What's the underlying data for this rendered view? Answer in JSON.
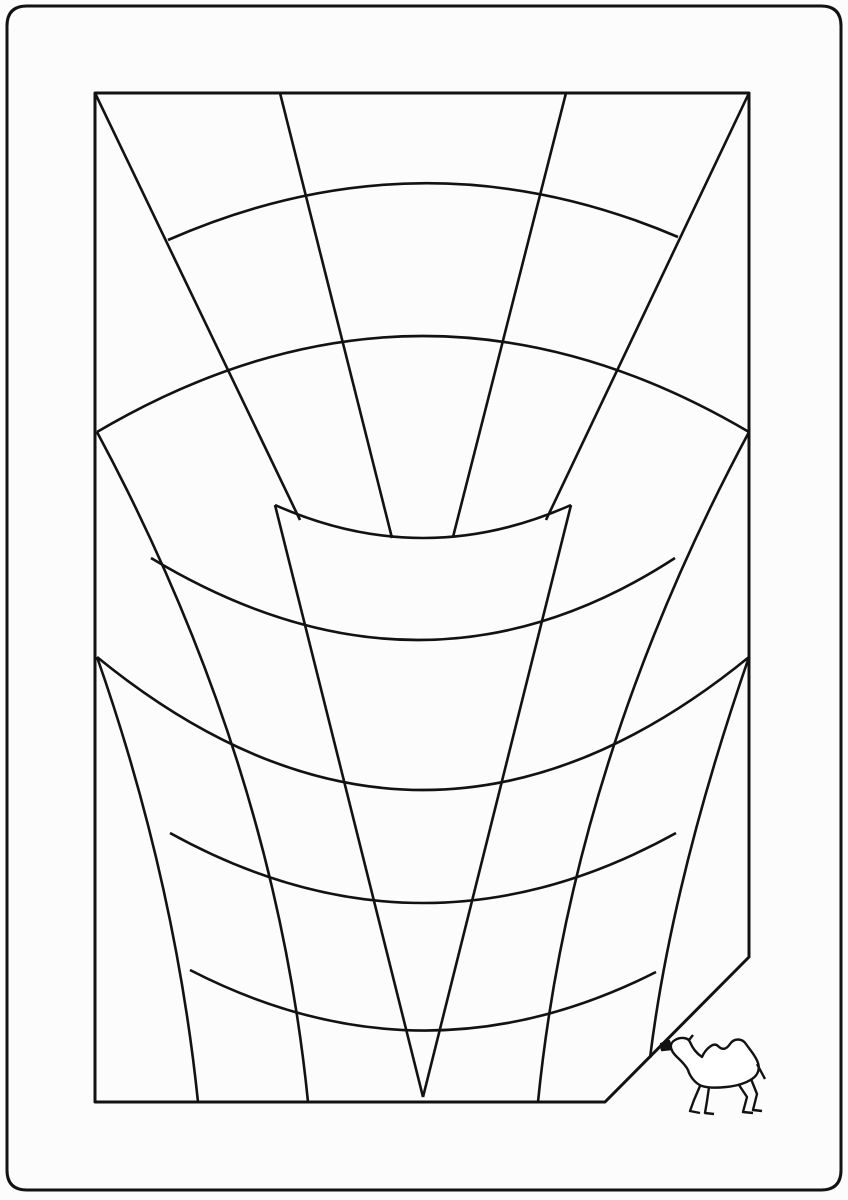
{
  "meta": {
    "description": "Maze puzzle line drawing with camel goal figure",
    "background_color": "#fcfcfc",
    "ink_color": "#121212",
    "line_width": 2.6,
    "frame_line_width": 3,
    "border_line_width": 3
  },
  "drawing": {
    "viewBox": "0 0 848 1200",
    "background": "#fcfcfc",
    "ink": "#121212",
    "frame": [
      {
        "name": "outer-rounded-border",
        "d": "M 27,6 H 821 Q 841,6 841,26 V 1170 Q 841,1190 821,1190 H 27 Q 7,1190 7,1170 V 26 Q 7,6 27,6 Z",
        "w": 3
      },
      {
        "name": "inner-frame-clipped-corner",
        "d": "M 95,93 H 749 V 957 L 605,1102 H 95 Z",
        "w": 3
      }
    ],
    "strokes": [
      {
        "name": "tier1-radial-left-corner",
        "d": "M 95,93 L 300,520"
      },
      {
        "name": "tier1-radial-center-left",
        "d": "M 280,93 L 392,538"
      },
      {
        "name": "tier1-radial-center-right",
        "d": "M 566,93 L 453,537"
      },
      {
        "name": "tier1-radial-right-corner",
        "d": "M 749,93 L 546,520"
      },
      {
        "name": "tier1-arc-upper",
        "d": "M 168,240 Q 423,128 678,237"
      },
      {
        "name": "tier1-arc-lower",
        "d": "M 97,432 Q 423,240 749,432"
      },
      {
        "name": "tier1-rim-sag",
        "d": "M 275,505 Q 423,571 571,505"
      },
      {
        "name": "tier2-radial-left-corner",
        "d": "M 97,432 Q 274,762 308,1102"
      },
      {
        "name": "tier2-radial-right-corner",
        "d": "M 749,432 Q 572,762 538,1102"
      },
      {
        "name": "tier2-radial-center-left",
        "d": "M 275,505 L 423,1097"
      },
      {
        "name": "tier2-radial-center-right",
        "d": "M 571,505 L 423,1097"
      },
      {
        "name": "tier2-arc-upper",
        "d": "M 151,558 Q 423,722 675,558"
      },
      {
        "name": "tier2-rim-sag",
        "d": "M 170,833 Q 423,973 676,833"
      },
      {
        "name": "tier3-radial-left-corner",
        "d": "M 97,657 Q 175,880 198,1102"
      },
      {
        "name": "tier3-radial-right-corner",
        "d": "M 749,657 Q 672,880 650,1058"
      },
      {
        "name": "tier3-arc-upper",
        "d": "M 97,657 Q 423,923 749,657"
      },
      {
        "name": "tier3-rim-sag",
        "d": "M 190,970 Q 423,1090 656,972"
      }
    ],
    "camel": {
      "name": "camel-figure",
      "body_fill": "#ffffff",
      "outline": "M 676,1056 C 671,1051 668,1044 675,1040 C 680,1037 688,1037 690,1042 C 692,1047 696,1053 702,1057 C 706,1048 714,1042 718,1046 C 722,1050 726,1050 730,1044 C 734,1038 742,1038 746,1044 C 750,1050 756,1056 758,1063 C 760,1069 758,1075 752,1079 C 746,1083 736,1086 726,1087 C 716,1088 708,1088 702,1086 C 696,1084 690,1077 688,1070 C 685,1064 680,1060 676,1056 Z",
      "details": [
        {
          "name": "camel-snout",
          "d": "M 669,1041 L 661,1044 L 662,1050 L 671,1049 Z",
          "fill": true
        },
        {
          "name": "camel-ear",
          "d": "M 689,1040 L 693,1035",
          "fill": false
        },
        {
          "name": "camel-tail",
          "d": "M 757,1064 L 765,1079",
          "fill": false
        },
        {
          "name": "camel-front-leg-1",
          "d": "M 700,1086 L 694,1100 L 690,1111 L 700,1113",
          "fill": false
        },
        {
          "name": "camel-front-leg-2",
          "d": "M 709,1087 L 707,1101 L 705,1113 L 714,1114",
          "fill": false
        },
        {
          "name": "camel-hind-leg-1",
          "d": "M 739,1085 L 747,1097 L 743,1112 L 753,1113",
          "fill": false
        },
        {
          "name": "camel-hind-leg-2",
          "d": "M 751,1079 L 757,1094 L 753,1110 L 762,1111",
          "fill": false
        }
      ]
    }
  }
}
